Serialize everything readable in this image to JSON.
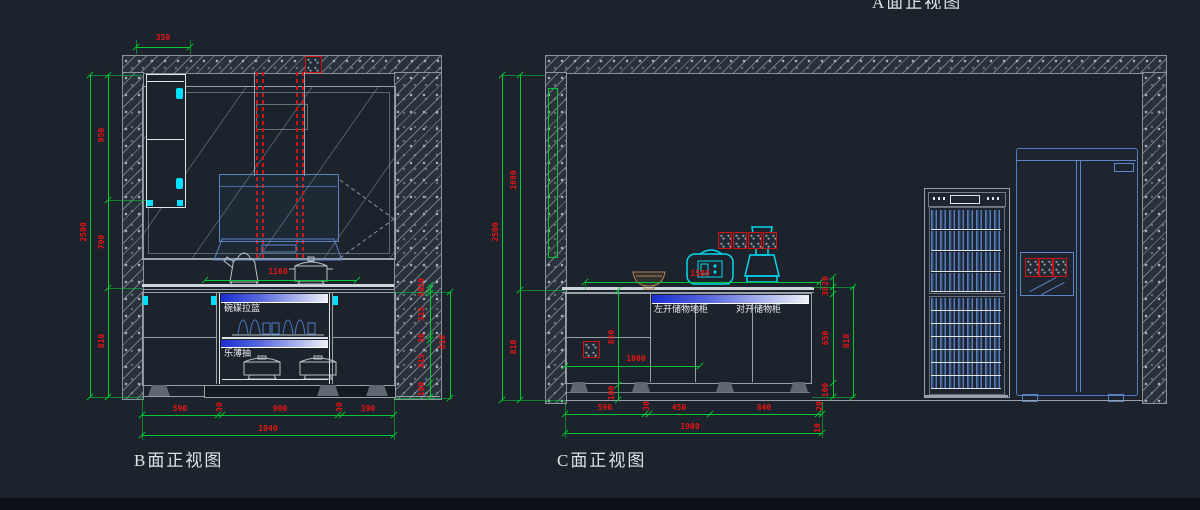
{
  "colors": {
    "background": "#1c232c",
    "dim_green": "#00c832",
    "dim_text_red": "#e81414",
    "line_grey": "#99a1aa",
    "line_white": "#dfe4ea",
    "accent_cyan": "#00e1ff",
    "steel_blue": "#5b86c4",
    "duct_red": "#d01212"
  },
  "view_a": {
    "title": "A面正视图"
  },
  "view_b": {
    "title": "B面正视图",
    "dims": {
      "top": "350",
      "left_total": "2500",
      "left_chain": [
        "950",
        "700",
        "810"
      ],
      "counter": "1160",
      "right_chain": [
        "20",
        "30",
        "315",
        "30",
        "315",
        "100"
      ],
      "right_total": "810",
      "bottom_chain": [
        "590",
        "30",
        "900",
        "30",
        "390"
      ],
      "bottom_total": "1940"
    },
    "labels": {
      "drawer_top": "碗碟拉篮",
      "drawer_bottom": "乐薄抽"
    }
  },
  "view_c": {
    "title": "C面正视图",
    "dims": {
      "left_total": "2500",
      "left_chain": [
        "1690",
        "810"
      ],
      "counter": "1500",
      "height": "1000",
      "mid_chain": [
        "850",
        "100"
      ],
      "right_chain": [
        "20",
        "30",
        "650",
        "100"
      ],
      "right_total": "810",
      "bottom_chain": [
        "590",
        "30",
        "450",
        "840",
        "20"
      ],
      "bottom_total": "1900",
      "bottom_end": "10"
    },
    "labels": {
      "cabinet_left": "左开储物地柜",
      "cabinet_right": "对开储物柜"
    }
  }
}
